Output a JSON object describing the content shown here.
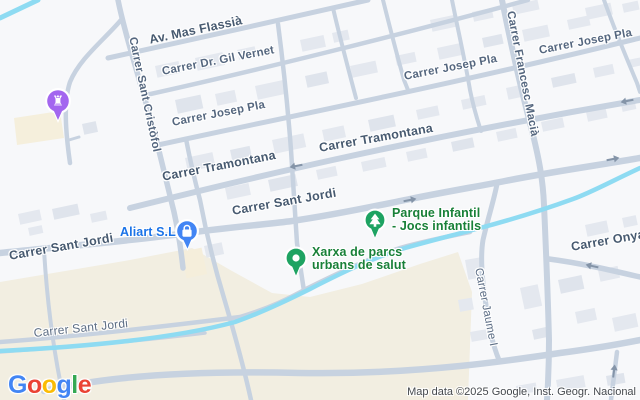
{
  "map": {
    "attribution": "Map data ©2025 Google, Inst. Geogr. Nacional",
    "logo": {
      "l0": "G",
      "l1": "o",
      "l2": "o",
      "l3": "g",
      "l4": "l",
      "l5": "e"
    },
    "streets": {
      "av_mas_flassia": "Av. Mas Flassià",
      "dr_gil_vernet": "Carrer Dr. Gil Vernet",
      "josep_pla": "Carrer Josep Pla",
      "tramontana": "Carrer Tramontana",
      "sant_cristofol": "Carrer Sant Cristòfol",
      "francesc_macia": "Carrer Francesc Macià",
      "sant_jordi": "Carrer Sant Jordi",
      "onyar": "Carrer Onyar",
      "jaume_i": "Carrer Jaume I"
    },
    "pois": {
      "aliart": {
        "label": "Aliart S.L"
      },
      "parque_infantil": {
        "line1": "Parque Infantil",
        "line2": "- Jocs infantils"
      },
      "xarxa": {
        "line1": "Xarxa de parcs",
        "line2": "urbans de salut"
      }
    },
    "icons": {
      "castle_glyph": "♜"
    },
    "colors": {
      "background": "#f7f8fa",
      "road": "#c7d2e0",
      "water": "#8edbf2",
      "terrain": "#f2eee1",
      "building": "#e4e8ef",
      "street_label": "#55677f",
      "poi_green": "#188038",
      "poi_blue": "#1a73e8",
      "marker_green": "#1ea362",
      "marker_blue": "#4285f4",
      "marker_purple": "#a366ef",
      "logo_blue": "#4285F4",
      "logo_red": "#EA4335",
      "logo_yellow": "#FBBC05",
      "logo_green": "#34A853"
    }
  }
}
